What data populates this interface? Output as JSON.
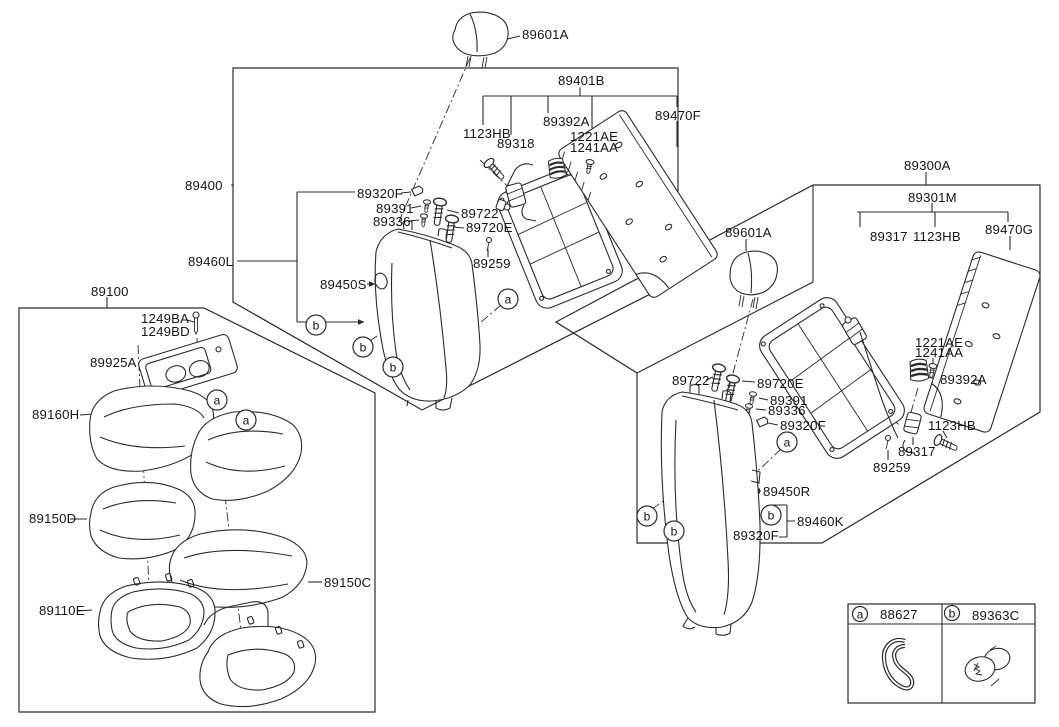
{
  "callouts": {
    "a": "a",
    "b": "b"
  },
  "left_backrest_group": {
    "group_code": "89400",
    "assembly_code": "89401B",
    "headrest_code": "89601A",
    "parts": {
      "bolt_1123hb": "1123HB",
      "wire_89318": "89318",
      "guide_89392a": "89392A",
      "screw_1221ae": "1221AE",
      "screw_1241aa": "1241AA",
      "board_89470f": "89470F",
      "clip_89320f": "89320F",
      "screw_89391": "89391",
      "screw_89336": "89336",
      "bolt_89722": "89722",
      "bolt_89720e": "89720E",
      "clip_89259": "89259",
      "cover_89450s": "89450S",
      "frame_89460l": "89460L"
    }
  },
  "cushion_group": {
    "group_code": "89100",
    "parts": {
      "pin_1249ba": "1249BA",
      "pin_1249bd": "1249BD",
      "tray_89925a": "89925A",
      "cushion_89160h": "89160H",
      "pad_89150d": "89150D",
      "pad_89150c": "89150C",
      "frame_89110e": "89110E"
    }
  },
  "right_backrest_group": {
    "group_code": "89300A",
    "assembly_code": "89301M",
    "headrest_code": "89601A",
    "parts": {
      "latch_89317_upper": "89317",
      "bolt_1123hb_upper": "1123HB",
      "board_89470g": "89470G",
      "screw_1221ae": "1221AE",
      "screw_1241aa": "1241AA",
      "guide_89392a": "89392A",
      "bolt_89722": "89722",
      "bolt_89720e": "89720E",
      "screw_89391": "89391",
      "screw_89336": "89336",
      "clip_89320f_upper": "89320F",
      "bolt_1123hb_lower": "1123HB",
      "latch_89317_lower": "89317",
      "clip_89259": "89259",
      "cover_89450r": "89450R",
      "frame_89460k": "89460K",
      "clip_89320f_lower": "89320F"
    }
  },
  "legend": {
    "items": [
      {
        "key": "a",
        "part_code": "88627"
      },
      {
        "key": "b",
        "part_code": "89363C"
      }
    ]
  }
}
